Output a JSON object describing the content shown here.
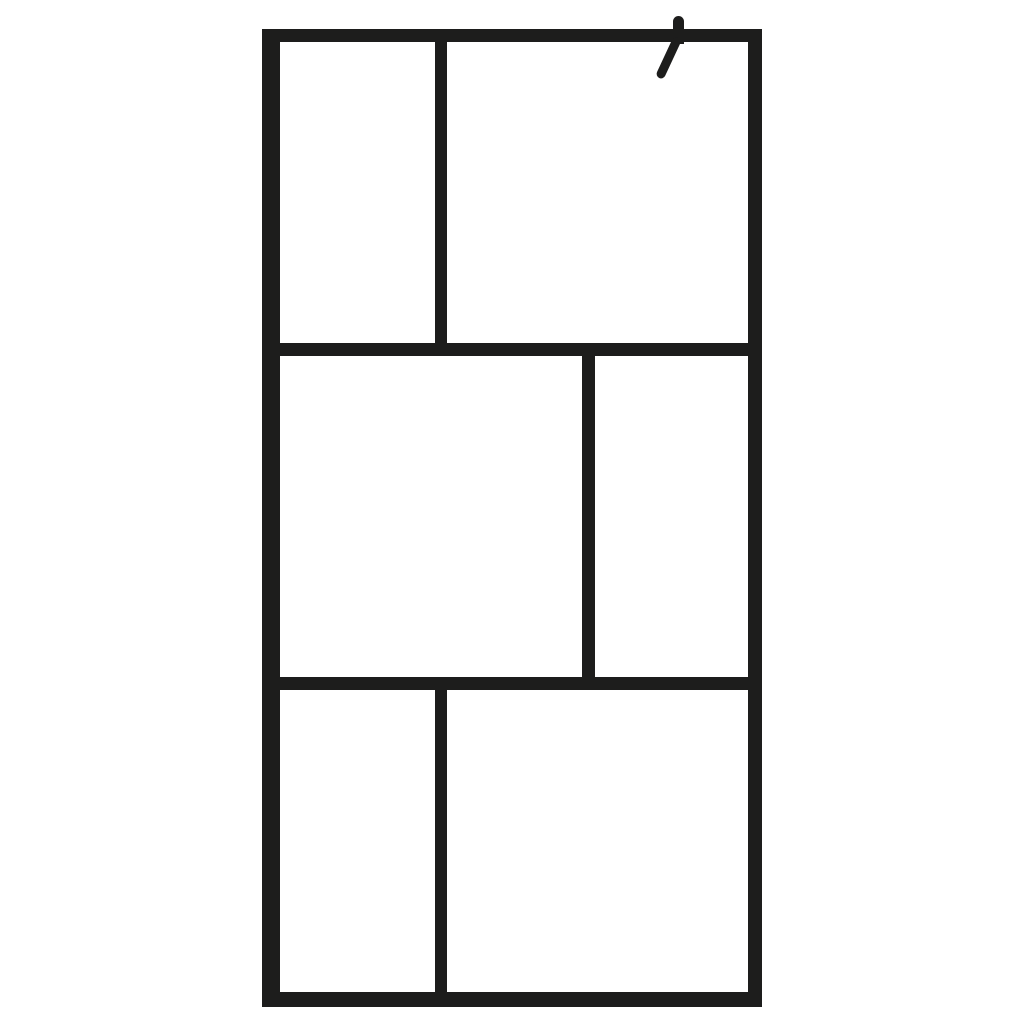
{
  "image": {
    "type": "product-photo",
    "subject": "walk-in-shower-glass-screen-with-black-frame-grid"
  },
  "colors": {
    "background": "#ffffff",
    "frame": "#1d1d1c",
    "glass": "#ffffff"
  },
  "frame": {
    "rows": 3,
    "panels_per_row": 2,
    "pattern": [
      "small-left / large-right",
      "large-left / small-right",
      "small-left / large-right"
    ]
  }
}
